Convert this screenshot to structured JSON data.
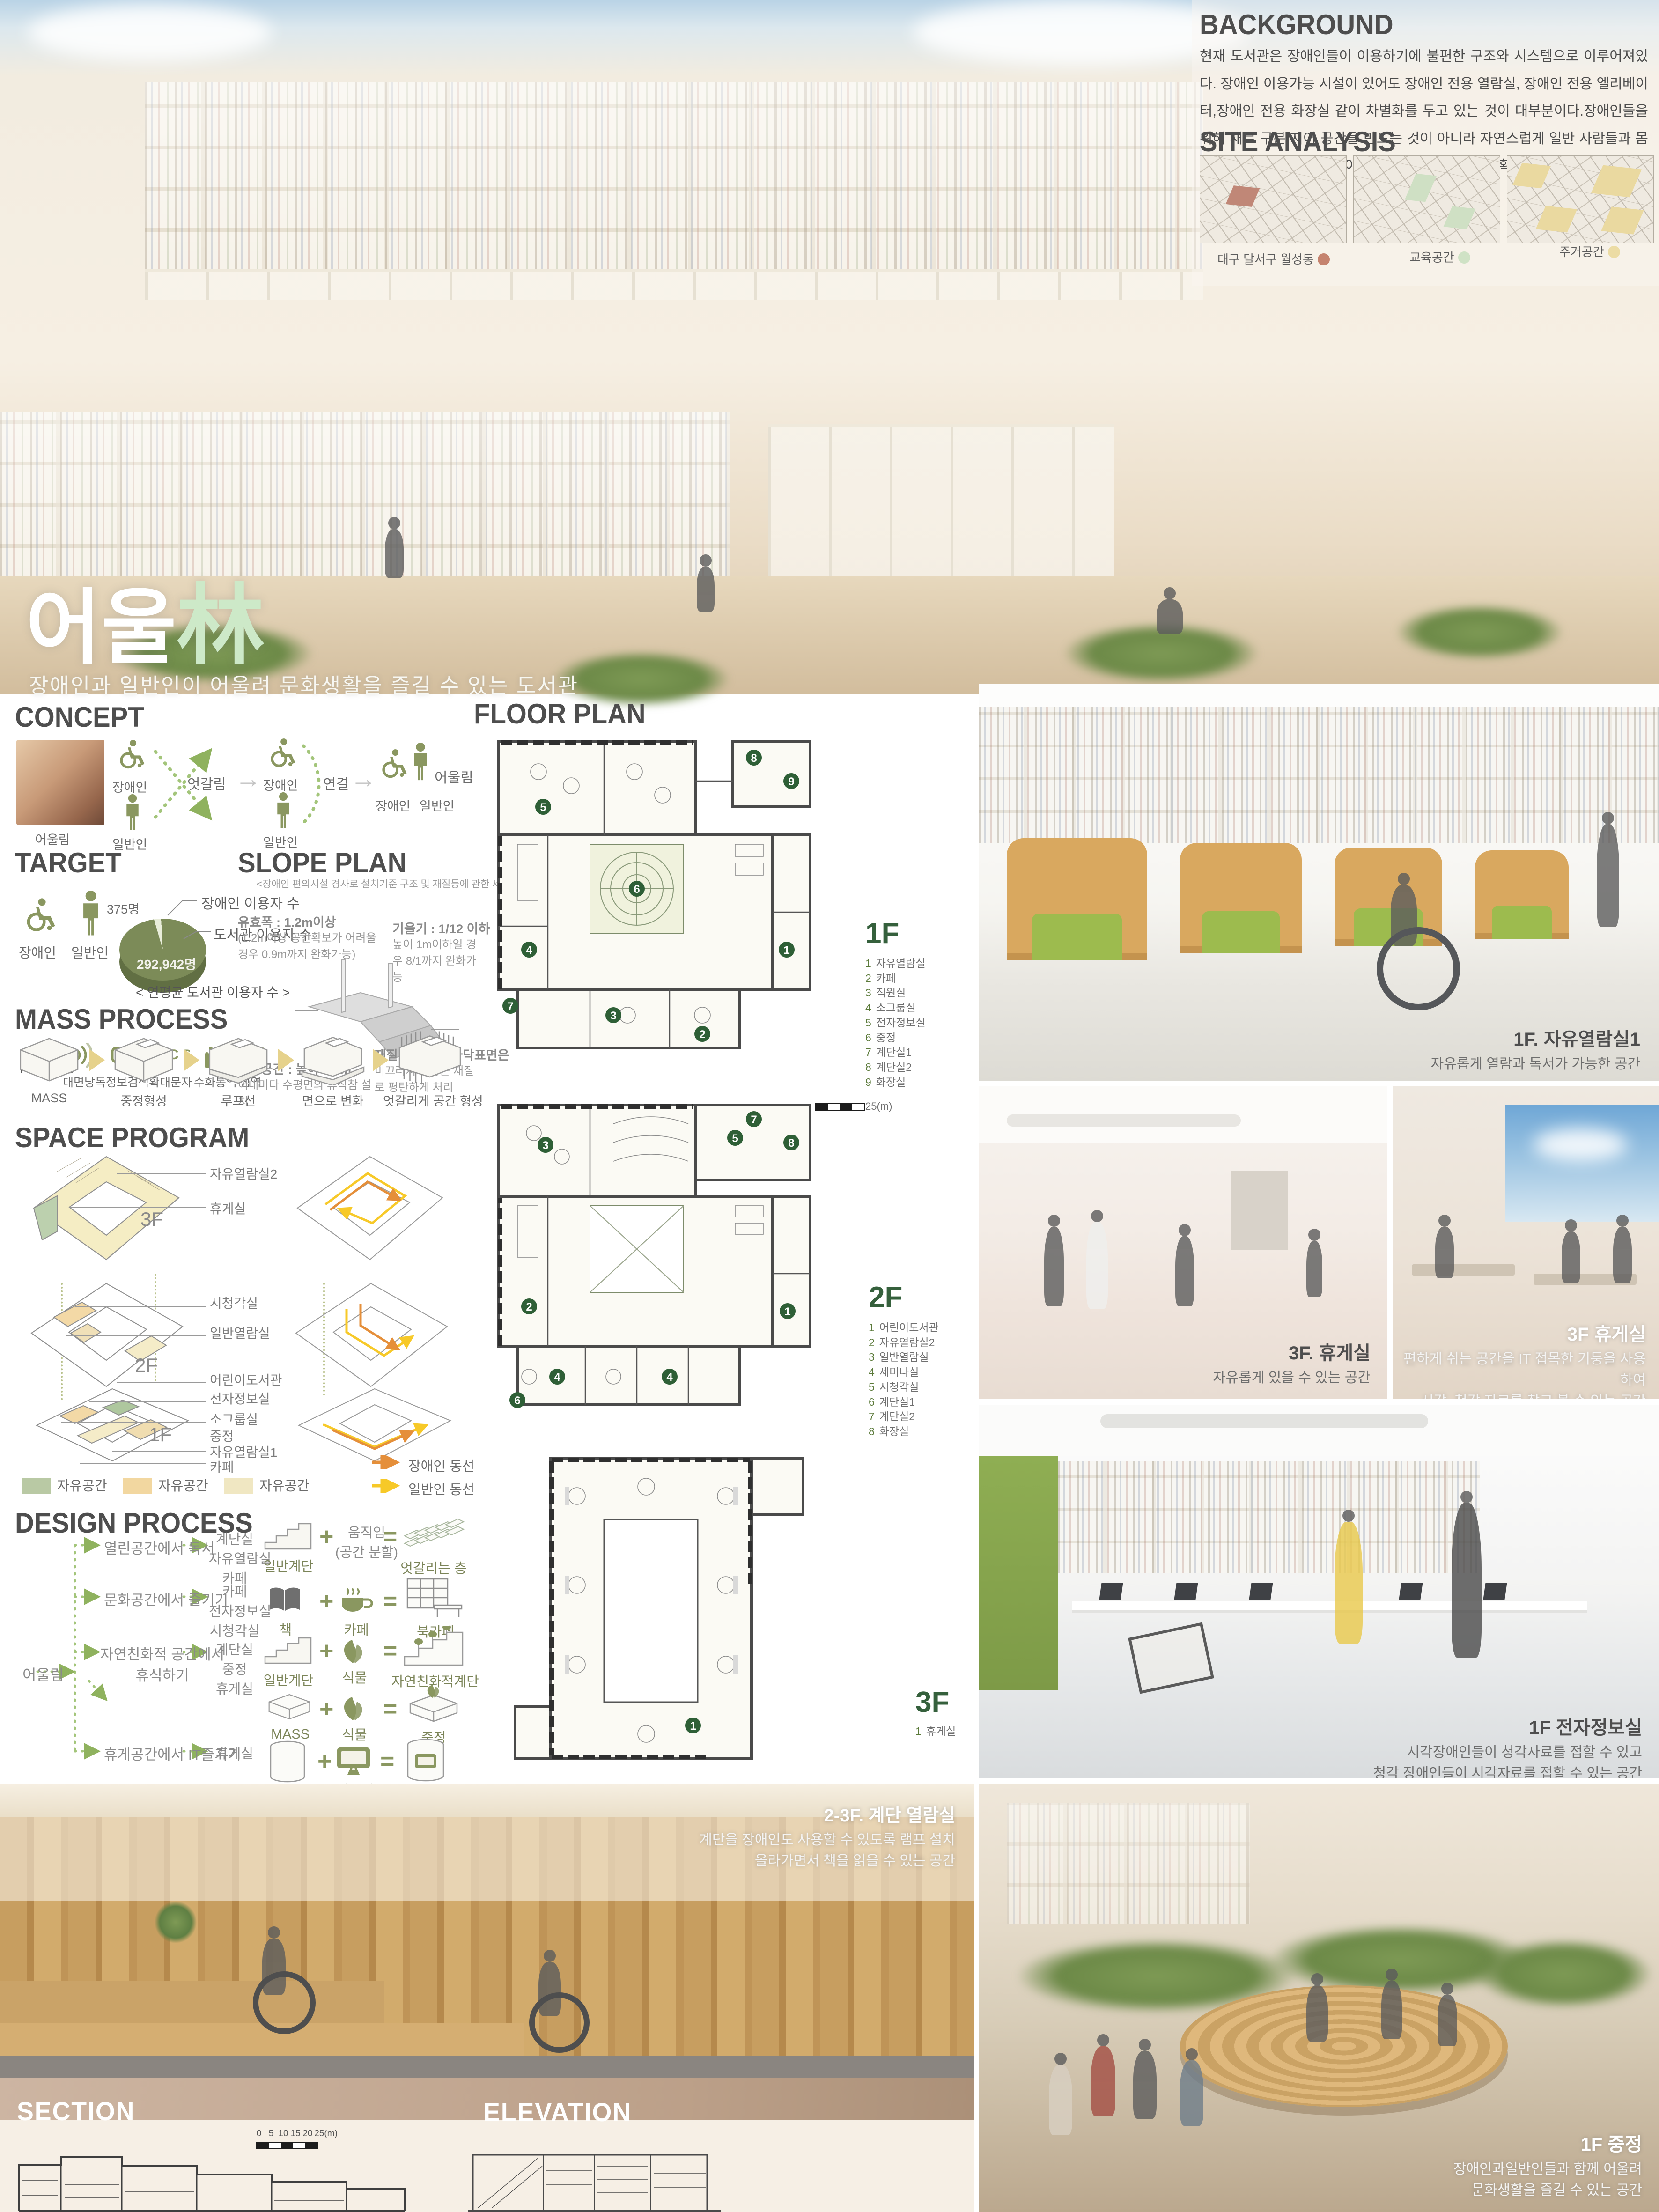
{
  "palette": {
    "accent_green": "#cde9c8",
    "olive": "#8a9760",
    "plan_green": "#2e5f36",
    "circulation_disabled": "#e58f3a",
    "circulation_general": "#f7c928"
  },
  "hero": {
    "title_ko": "어울",
    "title_hanja": "林",
    "subtitle": "장애인과 일반인이 어울려 문화생활을 즐길 수 있는 도서관"
  },
  "background": {
    "title": "BACKGROUND",
    "body": "현재 도서관은 장애인들이 이용하기에 불편한 구조와 시스템으로 이루어져있다. 장애인 이용가능 시설이 있어도 장애인 전용 열람실, 장애인 전용 엘리베이터,장애인 전용 화장실 같이 차별화를 두고 있는 것이 대부분이다.장애인들을 위해 새로 구분 지어 공간을 만드는 것이 아니라 자연스럽게 일반 사람들과 몸이 불편한 장애인이 함께 이용이 편리한 도서관을 계획하고자 한다."
  },
  "site_analysis": {
    "title": "SITE ANALYSIS",
    "maps": [
      {
        "label": "대구 달서구 월성동",
        "dot_color": "#c5836e"
      },
      {
        "label": "교육공간",
        "dot_color": "#cfe2c5"
      },
      {
        "label": "주거공간",
        "dot_color": "#ecdca4"
      }
    ]
  },
  "concept": {
    "title": "CONCEPT",
    "photo_label": "어울림",
    "disabled_label": "장애인",
    "general_label": "일반인",
    "cross_label": "엇갈림",
    "link_label": "연결",
    "result_label": "어울림",
    "result_disabled": "장애인",
    "result_general": "일반인"
  },
  "target": {
    "title": "TARGET",
    "disabled_label": "장애인",
    "general_label": "일반인",
    "pie": {
      "small_value": "375명",
      "small_label": "장애인 이용자 수",
      "big_value": "292,942명",
      "big_label": "도서관 이용자 수",
      "caption": "< 연평균 도서관 이용자 수 >"
    },
    "needs": {
      "label": "NEEDS",
      "items": [
        "대면낭독",
        "정보검색",
        "확대문자",
        "수화통역",
        "점역"
      ]
    }
  },
  "slope_plan": {
    "title": "SLOPE PLAN",
    "note": "<장애인 편의시설 경사로 설치기준 구조 및 재질등에 관한 세부사항>",
    "items": [
      {
        "label": "유효폭",
        "value": "1.2m이상",
        "detail": "(1.2m이상 공간확보가 어려울 경우 0.9m까지 완화가능)"
      },
      {
        "label": "기울기",
        "value": "1/12 이하",
        "detail": "높이 1m이하일 경우 8/1까지 완화가능"
      },
      {
        "label": "활동공간",
        "value": "높이 0.7m",
        "detail": "이내마다 수평면의 휴식참 설치"
      },
      {
        "label": "재질 및 마감",
        "value": "바닥표면은",
        "detail": "미끄러지지 않는 재질로 평탄하게 처리"
      }
    ]
  },
  "mass_process": {
    "title": "MASS PROCESS",
    "steps": [
      "MASS",
      "중정형성",
      "루프선",
      "면으로 변화",
      "엇갈리게 공간 형성"
    ]
  },
  "space_program": {
    "title": "SPACE PROGRAM",
    "floors": [
      {
        "floor": "3F",
        "labels": [
          "자유열람실2",
          "휴게실"
        ]
      },
      {
        "floor": "2F",
        "labels": [
          "시청각실",
          "일반열람실",
          "어린이도서관"
        ]
      },
      {
        "floor": "1F",
        "labels": [
          "전자정보실",
          "소그룹실",
          "중정",
          "자유열람실1",
          "카페"
        ]
      }
    ],
    "legend": [
      {
        "color": "#b9c9a4",
        "label": "자유공간"
      },
      {
        "color": "#f2d7a0",
        "label": "자유공간"
      },
      {
        "color": "#f0e7c2",
        "label": "자유공간"
      }
    ],
    "circulation": [
      {
        "color": "#e58f3a",
        "label": "장애인 동선"
      },
      {
        "color": "#f7c928",
        "label": "일반인 동선"
      }
    ]
  },
  "design_process": {
    "title": "DESIGN PROCESS",
    "root": "어울림",
    "branches": [
      {
        "activity": "열린공간에서 독서",
        "spaces": [
          "계단실",
          "자유열람실",
          "카페"
        ]
      },
      {
        "activity": "문화공간에서 즐기기",
        "spaces": [
          "카페",
          "전자정보실",
          "시청각실"
        ]
      },
      {
        "activity": "자연친화적 공간에서",
        "activity2": "휴식하기",
        "spaces": [
          "계단실",
          "중정",
          "휴게실"
        ]
      },
      {
        "activity": "휴게공간에서 IT즐기기",
        "spaces": [
          "휴게실"
        ]
      }
    ],
    "formulas": [
      {
        "a": "일반계단",
        "b": "움직임",
        "b2": "(공간 분할)",
        "result": "엇갈리는 층"
      },
      {
        "a": "책",
        "b": "카페",
        "result": "북카페"
      },
      {
        "a": "일반계단",
        "b": "식물",
        "result": "자연친화적계단"
      },
      {
        "a": "MASS",
        "b": "식물",
        "result": "중정"
      },
      {
        "a": "기둥",
        "b": "컴퓨터",
        "result": "옥상휴게실"
      }
    ]
  },
  "floor_plan": {
    "title": "FLOOR PLAN",
    "scale_label": "25(m)",
    "floors": [
      {
        "name": "1F",
        "rooms": [
          {
            "num": "1",
            "label": "자유열람실"
          },
          {
            "num": "2",
            "label": "카페"
          },
          {
            "num": "3",
            "label": "직원실"
          },
          {
            "num": "4",
            "label": "소그룹실"
          },
          {
            "num": "5",
            "label": "전자정보실"
          },
          {
            "num": "6",
            "label": "중정"
          },
          {
            "num": "7",
            "label": "계단실1"
          },
          {
            "num": "8",
            "label": "계단실2"
          },
          {
            "num": "9",
            "label": "화장실"
          }
        ]
      },
      {
        "name": "2F",
        "rooms": [
          {
            "num": "1",
            "label": "어린이도서관"
          },
          {
            "num": "2",
            "label": "자유열람실2"
          },
          {
            "num": "3",
            "label": "일반열람실"
          },
          {
            "num": "4",
            "label": "세미나실"
          },
          {
            "num": "5",
            "label": "시청각실"
          },
          {
            "num": "6",
            "label": "계단실1"
          },
          {
            "num": "7",
            "label": "계단실2"
          },
          {
            "num": "8",
            "label": "화장실"
          }
        ]
      },
      {
        "name": "3F",
        "rooms": [
          {
            "num": "1",
            "label": "휴게실"
          }
        ]
      }
    ]
  },
  "renders": {
    "reading_room": {
      "title": "1F. 자유열람실1",
      "desc": "자유롭게 열람과 독서가 가능한 공간"
    },
    "rest_room_a": {
      "title": "3F. 휴게실",
      "desc": "자유롭게 있을 수 있는 공간"
    },
    "rest_room_b": {
      "title": "3F 휴게실",
      "desc1": "편하게 쉬는 공간을 IT 접목한 기둥을 사용하여",
      "desc2": "시각. 청각 자료를 찾고 볼 수 있는 공간"
    },
    "digital_room": {
      "title": "1F 전자정보실",
      "desc1": "시각장애인들이 청각자료를 접할 수 있고",
      "desc2": "청각 장애인들이 시각자료를 접할 수 있는 공간"
    },
    "stair_reading": {
      "title": "2-3F. 계단 열람실",
      "desc1": "계단을 장애인도 사용할 수 있도록 램프 설치",
      "desc2": "올라가면서 책을 읽을 수 있는 공간"
    },
    "courtyard": {
      "title": "1F 중정",
      "desc1": "장애인과일반인들과 함께 어울려",
      "desc2": "문화생활을 즐길 수 있는 공간"
    }
  },
  "drawings": {
    "section_title": "SECTION",
    "elevation_title": "ELEVATION",
    "scale_ticks": [
      "0",
      "5",
      "10",
      "15",
      "20",
      "25(m)"
    ]
  }
}
